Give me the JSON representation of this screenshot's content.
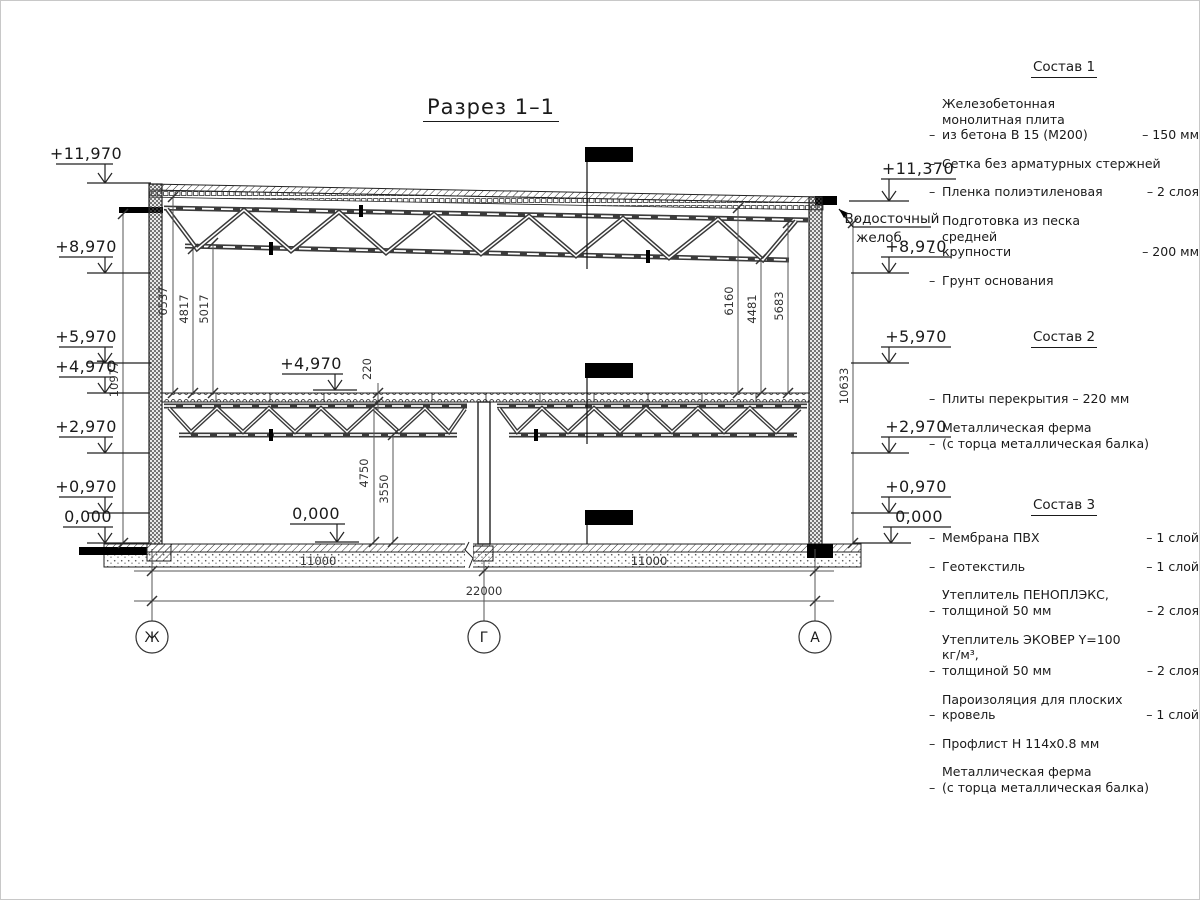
{
  "title": "Разрез 1–1",
  "misc": {
    "dash": "–"
  },
  "drawing": {
    "levels_left": [
      "+11,970",
      "+8,970",
      "+5,970",
      "+4,970",
      "+2,970",
      "+0,970",
      "0,000"
    ],
    "levels_right": [
      "+11,370",
      "+8,970",
      "+5,970",
      "+2,970",
      "+0,970",
      "0,000"
    ],
    "inner_levels": [
      "+4,970",
      "0,000"
    ],
    "gutter_label_line1": "Водосточный",
    "gutter_label_line2": "желоб",
    "dims_left": [
      "6537",
      "4817",
      "5017"
    ],
    "dims_right": [
      "6160",
      "4481",
      "5683"
    ],
    "dim_overall_left": "10977",
    "dim_overall_right": "10633",
    "dim_floor_thickness": "220",
    "dim_clear_height_1": "4750",
    "dim_clear_height_2": "3550",
    "dims_bottom": [
      "11000",
      "11000",
      "22000"
    ],
    "axes": [
      "Ж",
      "Г",
      "А"
    ]
  },
  "panels": [
    {
      "heading": "Состав 1",
      "items": [
        {
          "label": "Железобетонная монолитная плита\nиз бетона В 15 (М200)",
          "value": "– 150 мм"
        },
        {
          "label": "Сетка без арматурных стержней",
          "value": ""
        },
        {
          "label": "Пленка полиэтиленовая",
          "value": "– 2 слоя"
        },
        {
          "label": "Подготовка из песка средней\nкрупности",
          "value": "– 200 мм"
        },
        {
          "label": "Грунт основания",
          "value": ""
        }
      ]
    },
    {
      "heading": "Состав 2",
      "items": [
        {
          "label": "Плиты перекрытия – 220 мм",
          "value": ""
        },
        {
          "label": "Металлическая ферма\n(с торца металлическая балка)",
          "value": ""
        }
      ]
    },
    {
      "heading": "Состав 3",
      "items": [
        {
          "label": "Мембрана ПВХ",
          "value": "– 1 слой"
        },
        {
          "label": "Геотекстиль",
          "value": "– 1 слой"
        },
        {
          "label": "Утеплитель ПЕНОПЛЭКС,\nтолщиной 50 мм",
          "value": "– 2 слоя"
        },
        {
          "label": "Утеплитель ЭКОВЕР Y=100 кг/м³,\nтолщиной 50 мм",
          "value": "– 2 слоя"
        },
        {
          "label": "Пароизоляция для плоских кровель",
          "value": "– 1 слой"
        },
        {
          "label": "Профлист Н 114х0.8 мм",
          "value": ""
        },
        {
          "label": "Металлическая ферма\n(с торца металлическая балка)",
          "value": ""
        }
      ]
    }
  ]
}
